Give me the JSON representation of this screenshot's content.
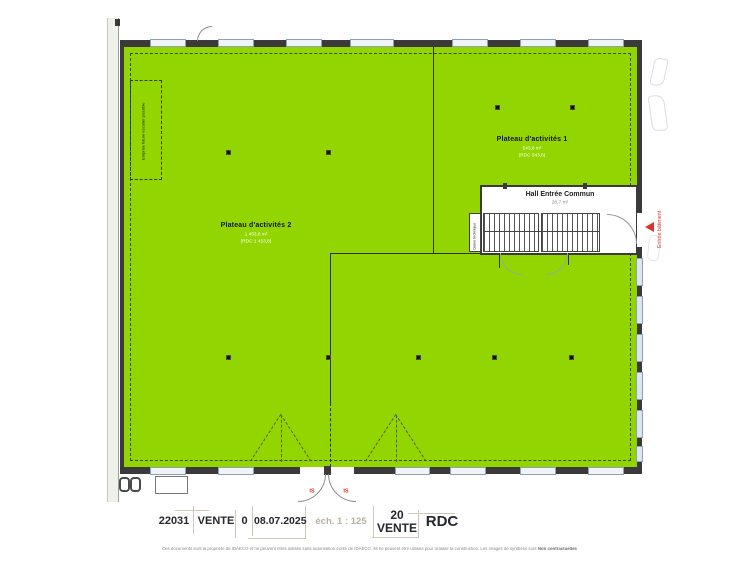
{
  "colors": {
    "zone_green": "#93d500",
    "wall": "#3a3a3a",
    "accent_red": "#d6342c",
    "window_blue": "#d8e7f0",
    "title_text": "#26262e",
    "muted_beige": "#b9b2a2"
  },
  "plan": {
    "future_stair_label": "Emprise future escalier possible",
    "plateau1": {
      "title": "Plateau d'activités 1",
      "area": "543,8 m²",
      "note": "(RDC 543,8)"
    },
    "plateau2": {
      "title": "Plateau d'activités 2",
      "area": "1 453,8 m²",
      "note": "(RDC 1 453,8)"
    },
    "hall": {
      "title": "Hall Entrée Commun",
      "area": "28,7 m²"
    },
    "gaine_label": "Gaine technique",
    "entrance_label": "Entrée bâtiment",
    "exit_left": "IS",
    "exit_right": "IS"
  },
  "titleblock": {
    "project": "22031",
    "phase": "VENTE",
    "index": "0",
    "date": "08.07.2025",
    "scale": "éch. 1 : 125",
    "lot": "20",
    "lot_phase": "VENTE",
    "level": "RDC"
  },
  "disclaimer": {
    "text": "Ces documents sont la propriété de IDAECO et ne peuvent êtres utilisés sans autorisation écrite de IDAECO. Ils ne peuvent être utilisés pour réaliser la construction. Les images de synthèse sont ",
    "bold": "Non contractuelles"
  }
}
